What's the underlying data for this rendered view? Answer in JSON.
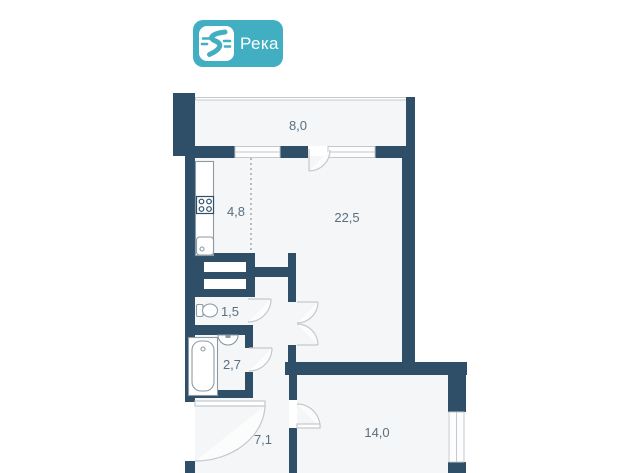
{
  "logo": {
    "text": "Река",
    "icon": "river-icon"
  },
  "colors": {
    "brand": "#41aec1",
    "wall": "#2f4f68",
    "floor": "#f4f6f7",
    "label": "#5a6e80",
    "line": "#c3c9cd",
    "fixture": "#8e9aa2"
  },
  "plan": {
    "type": "apartment-floor-plan",
    "area_unit": "m2",
    "rooms": {
      "balcony": {
        "area": "8,0"
      },
      "kitchen": {
        "area": "4,8"
      },
      "living": {
        "area": "22,5"
      },
      "wc": {
        "area": "1,5"
      },
      "bathroom": {
        "area": "2,7"
      },
      "hallway": {
        "area": "7,1"
      },
      "bedroom": {
        "area": "14,0"
      }
    },
    "fixtures": [
      "stove-icon",
      "kitchen-sink-icon",
      "toilet-icon",
      "bath-sink-icon",
      "bathtub-icon",
      "wardrobe-icon"
    ]
  }
}
